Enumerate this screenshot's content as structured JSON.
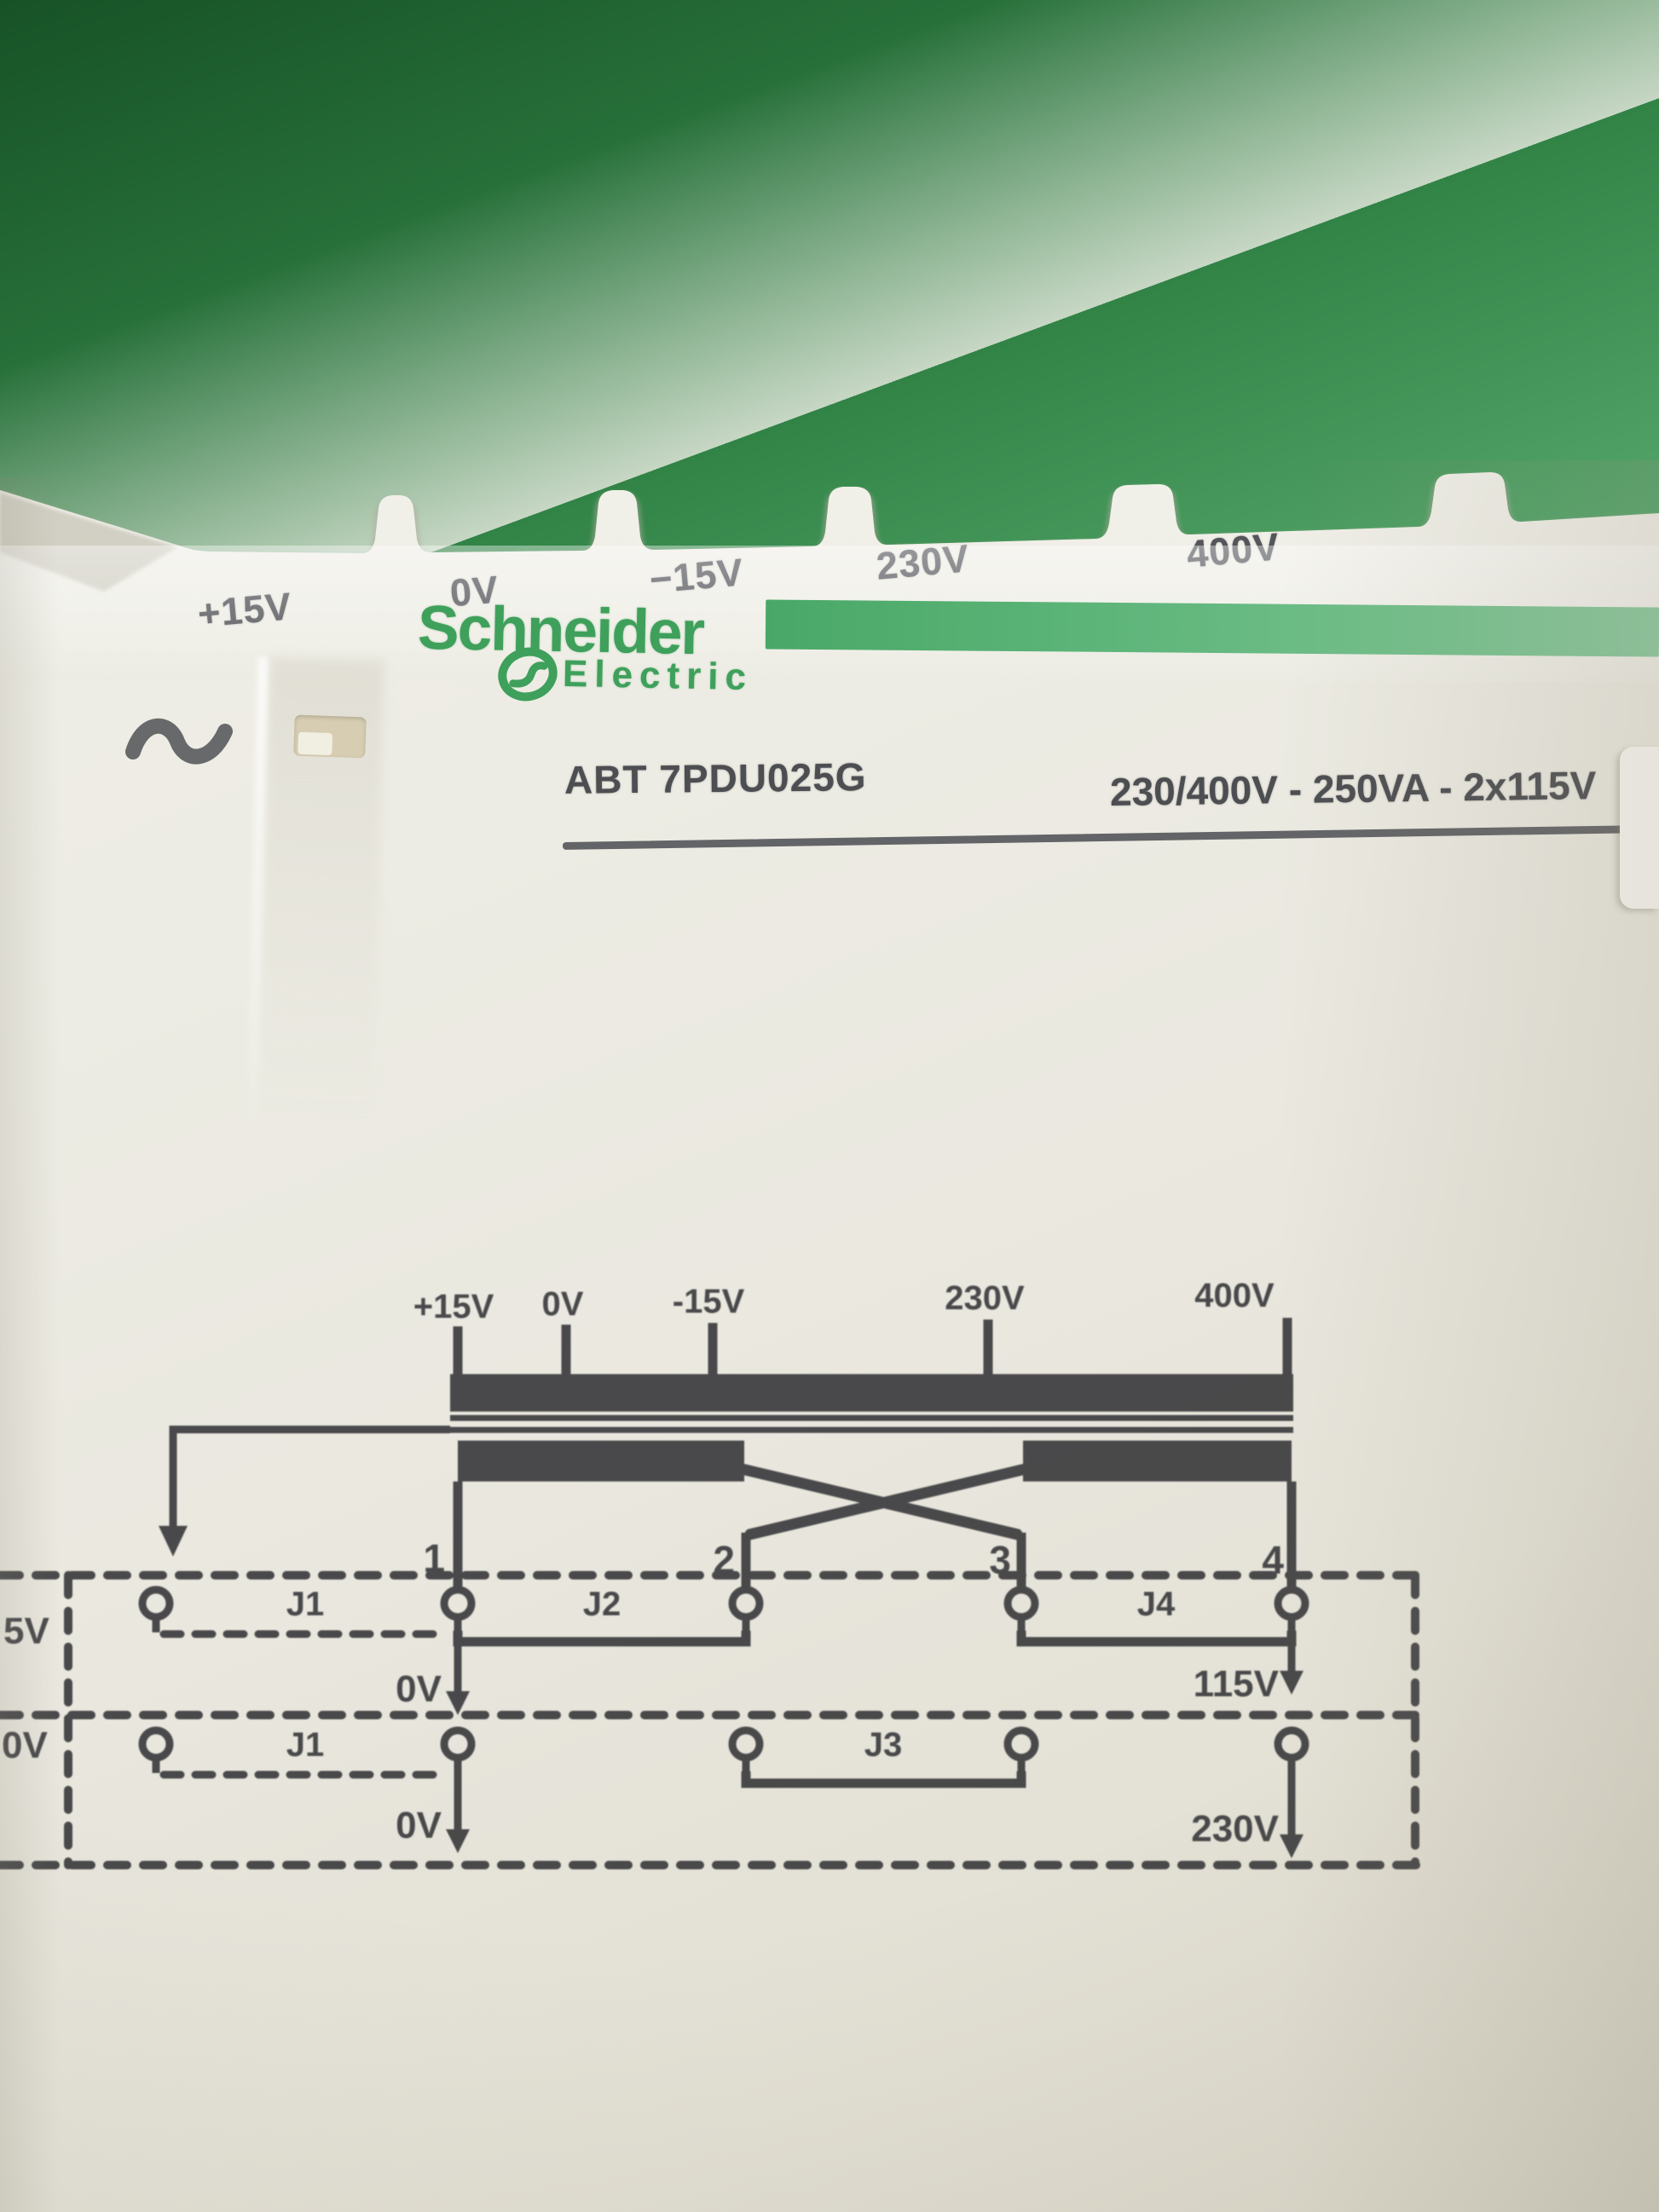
{
  "scene": {
    "description": "photo of a Schneider Electric transformer module against a green background"
  },
  "device": {
    "top_terminals": [
      "+15V",
      "0V",
      "−15V",
      "230V",
      "400V"
    ],
    "brand": {
      "name": "Schneider",
      "subname": "Electric"
    },
    "model": "ABT 7PDU025G",
    "rating": "230/400V - 250VA - 2x115V",
    "ac_symbol": "∼"
  },
  "diagram": {
    "taps": [
      "+15V",
      "0V",
      "-15V",
      "230V",
      "400V"
    ],
    "terminal_numbers": [
      "1",
      "2",
      "3",
      "4"
    ],
    "rows": [
      {
        "left_label_cut": "5V",
        "jumpers": [
          {
            "name": "J1",
            "state": "open"
          },
          {
            "name": "J2",
            "state": "closed"
          },
          {
            "name": "J4",
            "state": "closed"
          }
        ],
        "outputs": [
          {
            "label": "0V"
          },
          {
            "label": "115V"
          }
        ]
      },
      {
        "left_label_cut": "0V",
        "jumpers": [
          {
            "name": "J1",
            "state": "open"
          },
          {
            "name": "J3",
            "state": "closed"
          }
        ],
        "outputs": [
          {
            "label": "0V"
          },
          {
            "label": "230V"
          }
        ]
      }
    ]
  },
  "icons": {
    "ac_symbol": "sine-wave",
    "schneider_mark": "schneider-s-ellipse"
  },
  "colors": {
    "background_green": "#2e7d41",
    "brand_green": "#3fa05b",
    "bar_green": "#5cb478",
    "label_ink": "#54555a",
    "print_ink": "#3f4042",
    "plastic": "#ecebe3",
    "sticker_white": "#f9f8f4"
  }
}
